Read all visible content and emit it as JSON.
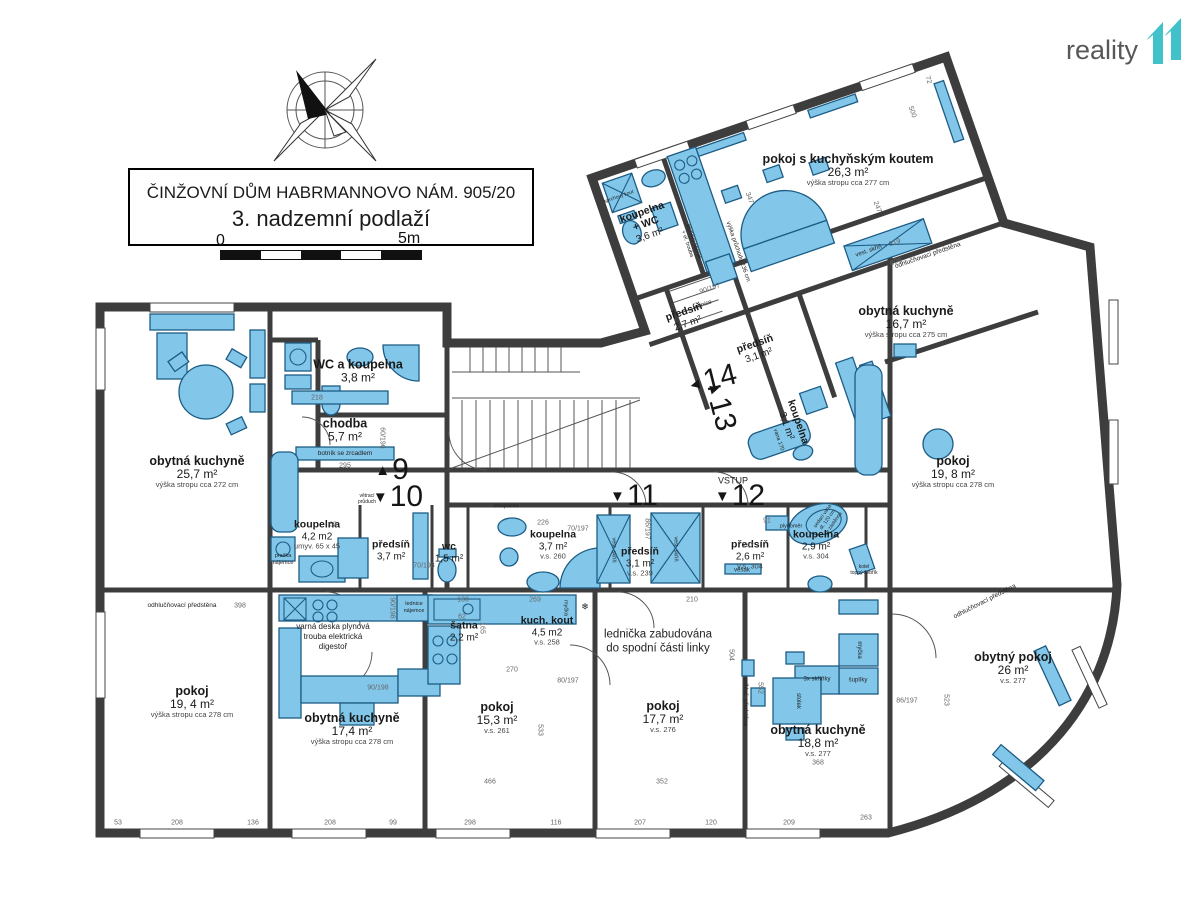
{
  "title": {
    "line1": "ČINŽOVNÍ DŮM HABRMANNOVO NÁM. 905/20",
    "line2": "3. nadzemní podlaží"
  },
  "logo": {
    "text": "reality",
    "mark": "11",
    "mark_color": "#41c1c9"
  },
  "scale": {
    "zero": "0",
    "five": "5m"
  },
  "colors": {
    "wall": "#3d3d3d",
    "fixture_fill": "#82c7ea",
    "fixture_stroke": "#1d5c85"
  },
  "rooms": [
    {
      "name": "obytná kuchyně",
      "area": "25,7 m²",
      "note": "výška stropu cca 272 cm"
    },
    {
      "name": "WC a koupelna",
      "area": "3,8 m²",
      "note": ""
    },
    {
      "name": "chodba",
      "area": "5,7 m²",
      "note": ""
    },
    {
      "name": "koupelna",
      "area": "4,2 m2",
      "note": "umyv. 65 x 45"
    },
    {
      "name": "předsíň",
      "area": "3,7 m²",
      "note": ""
    },
    {
      "name": "wc",
      "area": "1,5 m²",
      "note": ""
    },
    {
      "name": "koupelna",
      "area": "3,7 m²",
      "note": "v.s. 260"
    },
    {
      "name": "předsíň",
      "area": "3,1 m²",
      "note": "v.s. 239"
    },
    {
      "name": "předsíň",
      "area": "2,6 m²",
      "note": "v.s. 304"
    },
    {
      "name": "koupelna",
      "area": "2,9 m²",
      "note": "v.s. 304"
    },
    {
      "name": "pokoj",
      "area": "19, 4 m²",
      "note": "výška stropu cca 278 cm"
    },
    {
      "name": "obytná kuchyně",
      "area": "17,4 m²",
      "note": "výška stropu cca 278 cm"
    },
    {
      "name": "šatna",
      "area": "2,2 m²",
      "note": ""
    },
    {
      "name": "kuch. kout",
      "area": "4,5 m2",
      "note": "v.s. 258"
    },
    {
      "name": "pokoj",
      "area": "15,3 m²",
      "note": "v.s. 261"
    },
    {
      "name": "pokoj",
      "area": "17,7 m²",
      "note": "v.s. 276"
    },
    {
      "name": "obytná kuchyně",
      "area": "18,8 m²",
      "note": "v.s. 277"
    },
    {
      "name": "obytný pokoj",
      "area": "26 m²",
      "note": "v.s. 277"
    },
    {
      "name": "pokoj",
      "area": "19, 8 m²",
      "note": "výška stropu cca 278 cm"
    },
    {
      "name": "obytná kuchyně",
      "area": "16,7 m²",
      "note": "výška stropu cca 275 cm"
    },
    {
      "name": "pokoj s kuchyňským koutem",
      "area": "26,3 m²",
      "note": "výška stropu cca 277 cm"
    },
    {
      "name": "koupelna\n+ WC",
      "area": "3,6 m²",
      "note": ""
    },
    {
      "name": "předsíň",
      "area": "2,7 m²",
      "note": ""
    },
    {
      "name": "předsíň",
      "area": "3,1 m²",
      "note": ""
    },
    {
      "name": "koupelna",
      "area": "3,1 m²",
      "note": ""
    }
  ],
  "units": {
    "u9": {
      "a": "▲",
      "n": "9"
    },
    "u10": {
      "a": "▼",
      "n": "10"
    },
    "u11": {
      "a": "▼",
      "n": "11"
    },
    "u12": {
      "a": "▼",
      "n": "12"
    },
    "u13": {
      "a": "▲",
      "n": "13"
    },
    "u14": {
      "a": "◄",
      "n": "14"
    }
  },
  "annotations": [
    {
      "t": "VSTUP",
      "x": 733,
      "y": 481,
      "fs": 9
    },
    {
      "t": "lednička zabudována\ndo spodní části linky",
      "x": 658,
      "y": 642,
      "fs": 11.5
    },
    {
      "t": "varná deska plynová\ntrouba elektrická\ndigestoř",
      "x": 333,
      "y": 637,
      "fs": 8
    },
    {
      "t": "botník se zrcadlem",
      "x": 345,
      "y": 454,
      "fs": 6.5
    },
    {
      "t": "lednice\nnájemce",
      "x": 414,
      "y": 608,
      "fs": 5.5
    },
    {
      "t": "pračka\nnájemce",
      "x": 283,
      "y": 560,
      "fs": 5.5
    },
    {
      "t": "myčka",
      "x": 858,
      "y": 650,
      "fs": 6,
      "r": 90
    },
    {
      "t": "šuplíky",
      "x": 858,
      "y": 681,
      "fs": 6
    },
    {
      "t": "3x skříňky",
      "x": 817,
      "y": 680,
      "fs": 6
    },
    {
      "t": "stolek",
      "x": 797,
      "y": 701,
      "fs": 6,
      "r": 90
    },
    {
      "t": "vest. skříň",
      "x": 613,
      "y": 550,
      "fs": 5.5,
      "r": 90
    },
    {
      "t": "vest. skříň",
      "x": 675,
      "y": 549,
      "fs": 5.5,
      "r": 90
    },
    {
      "t": "vest. skříň",
      "x": 869,
      "y": 252,
      "fs": 6,
      "r": -19
    },
    {
      "t": "věšák",
      "x": 742,
      "y": 571,
      "fs": 6
    },
    {
      "t": "plynoměr",
      "x": 791,
      "y": 527,
      "fs": 5.5
    },
    {
      "t": "lednice",
      "x": 703,
      "y": 306,
      "fs": 6,
      "r": -19
    },
    {
      "t": "plynový sporák\n+ el. trouba",
      "x": 690,
      "y": 243,
      "fs": 5.5,
      "r": 71
    },
    {
      "t": "výška průchodu 236 cm",
      "x": 737,
      "y": 252,
      "fs": 6,
      "r": 71
    },
    {
      "t": "odhlučňovací předstěna",
      "x": 182,
      "y": 606,
      "fs": 6.5
    },
    {
      "t": "odhluč. předstěna",
      "x": 744,
      "y": 702,
      "fs": 6,
      "r": 90
    },
    {
      "t": "odhlučňovací předstěna",
      "x": 985,
      "y": 602,
      "fs": 6.5,
      "r": -27
    },
    {
      "t": "odhlučňovací předstěna",
      "x": 928,
      "y": 256,
      "fs": 6.5,
      "r": -19
    },
    {
      "t": "sedací vana\ndl. 120 cm\nse zástěnou",
      "x": 828,
      "y": 520,
      "fs": 5,
      "r": -55
    },
    {
      "t": "kotel\ntopný žebřík",
      "x": 864,
      "y": 570,
      "fs": 5
    },
    {
      "t": "sprchový kout",
      "x": 619,
      "y": 197,
      "fs": 5,
      "r": -19
    },
    {
      "t": "větrací\nprůduch",
      "x": 367,
      "y": 499,
      "fs": 5
    },
    {
      "t": "stoupačka",
      "x": 506,
      "y": 507,
      "fs": 5.5
    },
    {
      "t": "vana 170",
      "x": 778,
      "y": 440,
      "fs": 5.5,
      "r": 71
    },
    {
      "t": "myčka",
      "x": 565,
      "y": 608,
      "fs": 5.5,
      "r": 90
    },
    {
      "t": "❄",
      "x": 585,
      "y": 607,
      "fs": 9
    }
  ],
  "dimensions": [
    {
      "t": "53",
      "x": 118,
      "y": 823
    },
    {
      "t": "208",
      "x": 177,
      "y": 823
    },
    {
      "t": "136",
      "x": 253,
      "y": 823
    },
    {
      "t": "208",
      "x": 330,
      "y": 823
    },
    {
      "t": "99",
      "x": 393,
      "y": 823
    },
    {
      "t": "298",
      "x": 470,
      "y": 823
    },
    {
      "t": "116",
      "x": 556,
      "y": 823
    },
    {
      "t": "207",
      "x": 640,
      "y": 823
    },
    {
      "t": "120",
      "x": 711,
      "y": 823
    },
    {
      "t": "209",
      "x": 789,
      "y": 823
    },
    {
      "t": "263",
      "x": 866,
      "y": 818
    },
    {
      "t": "398",
      "x": 240,
      "y": 606
    },
    {
      "t": "90/198",
      "x": 378,
      "y": 688
    },
    {
      "t": "90/198",
      "x": 392,
      "y": 608,
      "r": 90
    },
    {
      "t": "70/198",
      "x": 424,
      "y": 566
    },
    {
      "t": "70/197",
      "x": 578,
      "y": 529
    },
    {
      "t": "226",
      "x": 543,
      "y": 523
    },
    {
      "t": "69",
      "x": 333,
      "y": 525
    },
    {
      "t": "60/196",
      "x": 382,
      "y": 438,
      "r": 90
    },
    {
      "t": "218",
      "x": 317,
      "y": 398
    },
    {
      "t": "295",
      "x": 345,
      "y": 466
    },
    {
      "t": "86/197",
      "x": 647,
      "y": 529,
      "r": 90
    },
    {
      "t": "86/197",
      "x": 907,
      "y": 701
    },
    {
      "t": "90/197",
      "x": 710,
      "y": 289,
      "r": -19
    },
    {
      "t": "247",
      "x": 748,
      "y": 546
    },
    {
      "t": "91",
      "x": 767,
      "y": 521
    },
    {
      "t": "466",
      "x": 490,
      "y": 782
    },
    {
      "t": "352",
      "x": 662,
      "y": 782
    },
    {
      "t": "368",
      "x": 818,
      "y": 763
    },
    {
      "t": "523",
      "x": 946,
      "y": 700,
      "r": 90
    },
    {
      "t": "504",
      "x": 731,
      "y": 655,
      "r": 90
    },
    {
      "t": "552",
      "x": 760,
      "y": 688,
      "r": 90
    },
    {
      "t": "533",
      "x": 540,
      "y": 730,
      "r": 90
    },
    {
      "t": "210",
      "x": 692,
      "y": 600
    },
    {
      "t": "270",
      "x": 512,
      "y": 670
    },
    {
      "t": "130",
      "x": 463,
      "y": 600
    },
    {
      "t": "269",
      "x": 535,
      "y": 600
    },
    {
      "t": "62",
      "x": 462,
      "y": 617
    },
    {
      "t": "165",
      "x": 482,
      "y": 628,
      "r": 90
    },
    {
      "t": "80/197",
      "x": 568,
      "y": 681
    },
    {
      "t": "347",
      "x": 749,
      "y": 198,
      "r": 71
    },
    {
      "t": "247",
      "x": 877,
      "y": 207,
      "r": 71
    },
    {
      "t": "319",
      "x": 895,
      "y": 243,
      "r": -19
    },
    {
      "t": "608",
      "x": 896,
      "y": 262,
      "r": -19
    },
    {
      "t": "72",
      "x": 928,
      "y": 80,
      "r": 71
    },
    {
      "t": "500",
      "x": 912,
      "y": 112,
      "r": 71
    }
  ]
}
